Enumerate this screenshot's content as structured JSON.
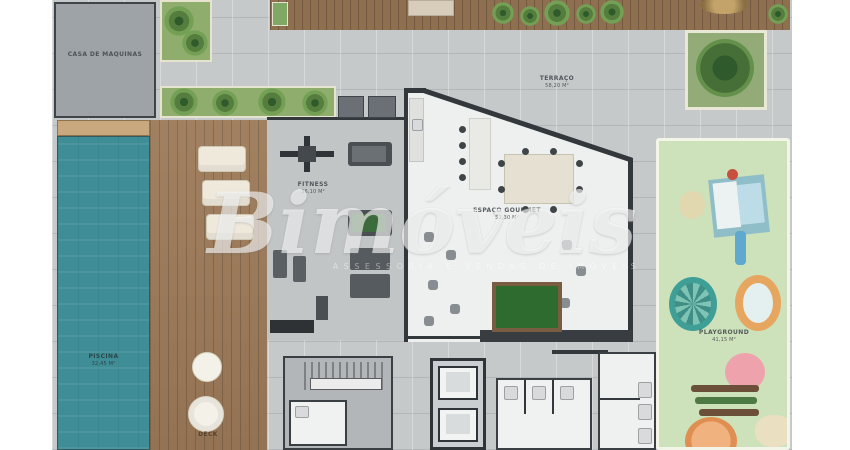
{
  "watermark": {
    "brand": "Bimóveis",
    "tagline": "ASSESSORIA E VENDAS DE IMÓVEIS"
  },
  "rooms": {
    "machine_room": {
      "label": "CASA DE MÁQUINAS"
    },
    "terrace": {
      "label": "TERRAÇO",
      "area": "58,20 m²"
    },
    "fitness": {
      "label": "FITNESS",
      "area": "36,10 m²"
    },
    "gourmet": {
      "label": "ESPAÇO GOURMET",
      "area": "52,30 m²"
    },
    "pool": {
      "label": "PISCINA",
      "area": "32,45 m²"
    },
    "deck": {
      "label": "DECK"
    },
    "playground": {
      "label": "PLAYGROUND",
      "area": "41,15 m²"
    }
  },
  "colors": {
    "pool_water": "#3f8d96",
    "deck_wood": "#9c7a58",
    "paving": "#c6c9ca",
    "playground_green": "#cde1bb",
    "planter_green": "#8fae6d",
    "wall": "#33383c",
    "billiard_green": "#2e6b2f"
  }
}
